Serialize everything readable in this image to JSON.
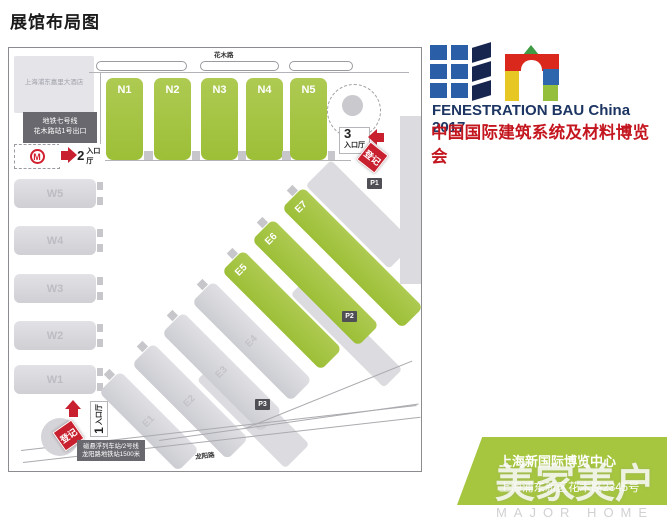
{
  "page": {
    "title": "展馆布局图"
  },
  "branding": {
    "title_en": "FENESTRATION BAU China 2017",
    "title_cn": "中国国际建筑系统及材料博览会"
  },
  "map": {
    "roads": {
      "top": "花木路",
      "bottom": "龙阳路"
    },
    "hotel_label": "上海浦东嘉里大酒店",
    "halls_n": [
      "N1",
      "N2",
      "N3",
      "N4",
      "N5"
    ],
    "halls_w": [
      "W5",
      "W4",
      "W3",
      "W2",
      "W1"
    ],
    "halls_e": [
      "E7",
      "E6",
      "E5",
      "E4",
      "E3",
      "E2",
      "E1"
    ],
    "parking": [
      "P1",
      "P2",
      "P3"
    ],
    "entrance1": {
      "num": "1",
      "label": "入口厅"
    },
    "entrance2": {
      "num": "2",
      "label": "入口厅"
    },
    "entrance3": {
      "num": "3",
      "label": "入口厅"
    },
    "badges": {
      "registration": "登记",
      "metro_logo_letter": "M",
      "metro_line1": "地铁七号线",
      "metro_line2": "花木路站1号出口",
      "maglev_line1": "磁悬浮列车站/2号线",
      "maglev_line2": "龙阳路地铁站1500米"
    }
  },
  "venue": {
    "name": "上海新国际博览中心",
    "address": "上海浦东新区花木路2345号"
  },
  "watermark": {
    "cn": "美家美户",
    "en": "MAJOR HOME"
  },
  "colors": {
    "hall_green": "#a5c63e",
    "hall_gray": "#d8d8dc",
    "badge_gray": "#68686e",
    "accent_red": "#c8202e",
    "brand_navy": "#1c3562",
    "brand_red": "#c4161f",
    "venue_green": "#a6c63f"
  }
}
